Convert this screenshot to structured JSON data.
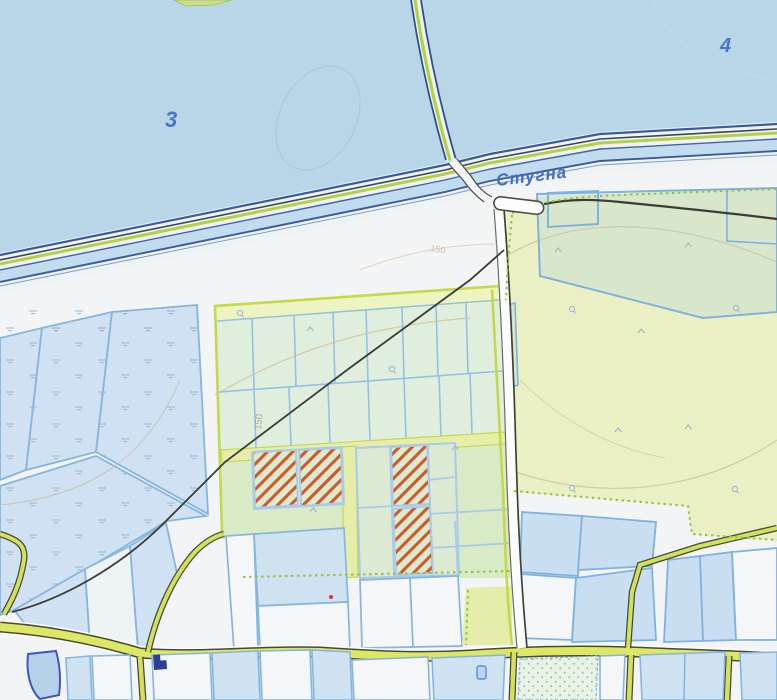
{
  "map": {
    "title": "Topographic cadastral map",
    "labels": {
      "water_zone_3": "3",
      "water_zone_4": "4",
      "river_name": "Стугна",
      "contour_elevation_main": "150",
      "contour_elevation_secondary": "150"
    },
    "palette": {
      "water": "#b9d6e9",
      "land": "#f2f4f6",
      "field_green": "#eaf0c4",
      "parcel_cell_green": "#dfeedd",
      "wetland_parcel_blue": "#cfe1f2",
      "parcel_border_blue": "#86b5de",
      "road_yellow": "#dde762",
      "block_border_green": "#c5d84c",
      "dotted_boundary_green": "#8fc43c",
      "hatch_orange": "#cf5a26",
      "embankment_navy": "#3a5a9c",
      "path_black": "#3c3c36",
      "label_blue": "#3f6ec5",
      "contour_tan": "#d8cba3",
      "pond_outline": "#4055c0"
    },
    "features": {
      "hatched_parcels_count": "4"
    }
  }
}
